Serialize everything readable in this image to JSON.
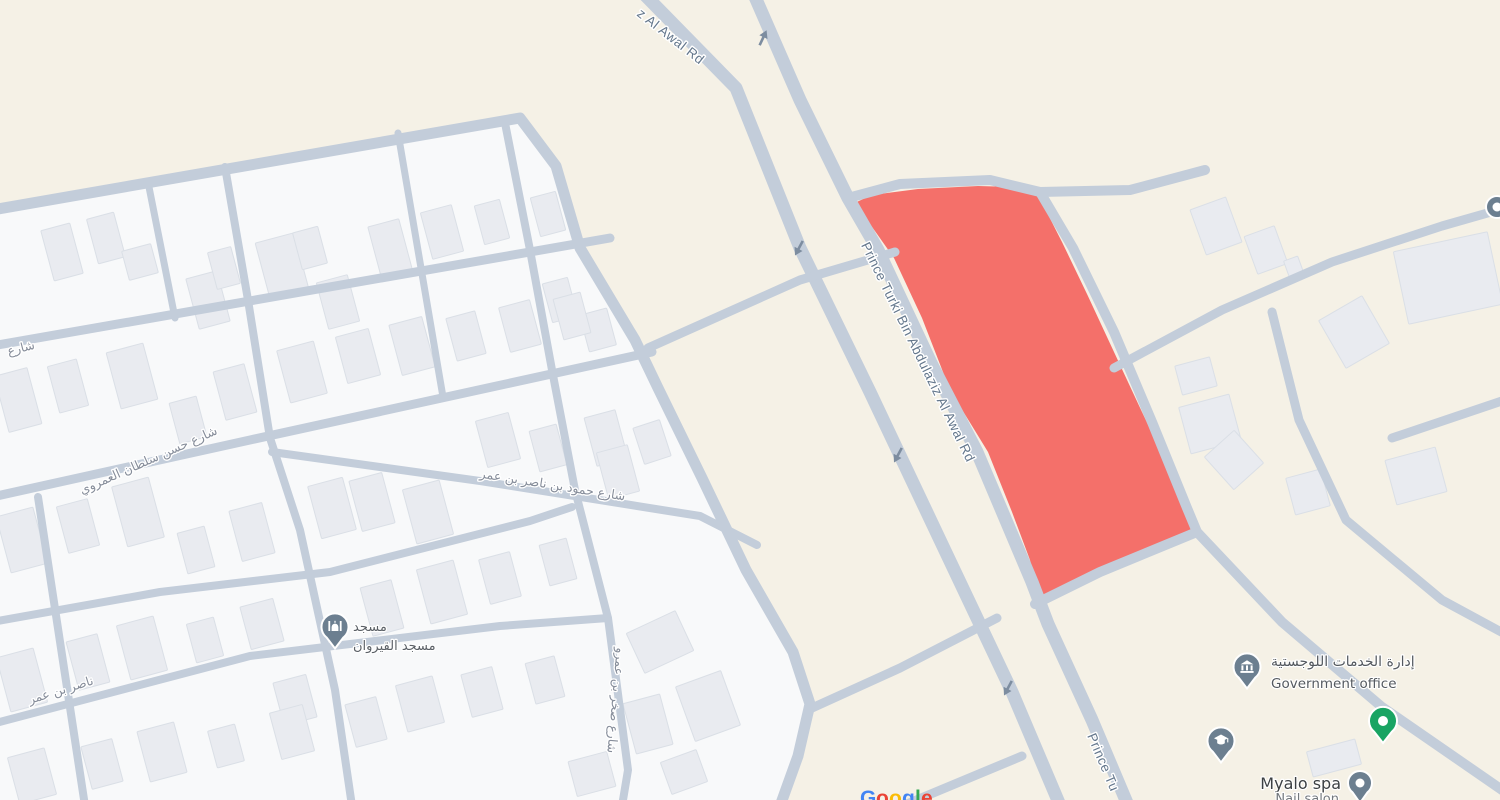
{
  "map": {
    "width": 1500,
    "height": 800,
    "colors": {
      "background": "#f5f1e6",
      "urban_fill": "#f8f9fa",
      "road": "#c3cdda",
      "building_fill": "#e9ebf0",
      "building_stroke": "#dadfe6",
      "parcel_fill": "#f4706a",
      "pin": "#6c7f90",
      "green_marker": "#19a463",
      "road_label": "#64778c",
      "street_label": "#868d9a",
      "poi_label": "#54595f",
      "arrow": "#7d8da0",
      "halo": "#ffffff"
    },
    "urban_area": "-8,212 520,120 556,168 580,250 635,342 658,390 702,480 746,572 793,654 809,705 797,756 779,806 -8,806",
    "parcel": "848,206 872,195 918,189 978,186 1014,187 1038,195 1062,242 1087,294 1114,352 1142,412 1170,472 1191,516 1197,533 1152,553 1100,576 1039,598 1030,560 1012,512 988,452 950,390 922,318 894,258 870,224",
    "roads": [
      {
        "name": "prince-turki-west-carriageway",
        "d": "M640,-10 L736,88 L800,248 L870,392 L940,540 L1012,692 L1062,810",
        "w": 13
      },
      {
        "name": "prince-turki-east-carriageway",
        "d": "M752,-10 L800,100 L848,198 L878,250 L932,365 L977,452 L1032,582 L1048,624 L1092,720 L1130,810",
        "w": 13
      },
      {
        "name": "parcel-north-road",
        "d": "M848,198 L900,184 L990,180 L1040,192 L1130,190 L1205,170",
        "w": 10
      },
      {
        "name": "parcel-east-road",
        "d": "M1040,192 L1073,248 L1114,332 L1152,422 L1187,508 L1197,532 L1282,622 L1382,707 L1505,792",
        "w": 10
      },
      {
        "name": "parcel-south-road",
        "d": "M1035,604 L1100,572 L1197,532",
        "w": 10
      },
      {
        "name": "branch-northeast-road",
        "d": "M1114,368 L1222,310 L1332,262 L1442,226 L1505,208",
        "w": 9
      },
      {
        "name": "branch-east-curve-road",
        "d": "M1272,312 L1299,420 L1346,520 L1442,600 L1505,634",
        "w": 9
      },
      {
        "name": "branch-east-stub-road",
        "d": "M1392,438 L1505,400",
        "w": 9
      },
      {
        "name": "mid-connector-road",
        "d": "M648,348 L800,280 L895,252",
        "w": 9
      },
      {
        "name": "south-connector-road",
        "d": "M812,708 L900,668 L997,618",
        "w": 9
      },
      {
        "name": "south-diagonal-road",
        "d": "M902,806 L1022,756",
        "w": 9
      },
      {
        "name": "urban-boundary-road",
        "d": "M-8,210 L520,118 L556,166 L580,248 L635,340 L658,388 L702,478 L746,570 L793,652 L810,704 L798,756 L780,806",
        "w": 11
      },
      {
        "name": "street-d2",
        "d": "M-8,346 L610,238",
        "w": 9
      },
      {
        "name": "street-hassan-sultan",
        "d": "M-8,497 L250,440 L652,352",
        "w": 9
      },
      {
        "name": "street-hamoud-nasser",
        "d": "M272,452 L480,481 L700,516 L757,545",
        "w": 8
      },
      {
        "name": "street-d4b",
        "d": "M-8,622 L160,592 L330,572 L530,521 L572,507",
        "w": 8
      },
      {
        "name": "street-d5",
        "d": "M-8,724 L250,656 L500,626 L608,618",
        "w": 8
      },
      {
        "name": "street-v0",
        "d": "M148,182 L175,318",
        "w": 7
      },
      {
        "name": "street-v1",
        "d": "M38,497 L85,806",
        "w": 8
      },
      {
        "name": "street-v2",
        "d": "M225,167 L248,300 L270,438 L300,530 L335,690 L352,806",
        "w": 8
      },
      {
        "name": "street-v2b",
        "d": "M398,133 L443,397",
        "w": 7
      },
      {
        "name": "street-sakhr",
        "d": "M505,123 L530,250 L552,370 L575,490 L608,618 L628,770 L622,806",
        "w": 8
      }
    ],
    "buildings": [
      [
        62,
        252,
        30,
        52
      ],
      [
        106,
        238,
        28,
        46
      ],
      [
        140,
        262,
        30,
        30
      ],
      [
        208,
        300,
        32,
        52
      ],
      [
        224,
        268,
        24,
        38
      ],
      [
        282,
        266,
        40,
        58
      ],
      [
        310,
        248,
        26,
        38
      ],
      [
        338,
        302,
        32,
        48
      ],
      [
        390,
        248,
        32,
        52
      ],
      [
        442,
        232,
        32,
        48
      ],
      [
        492,
        222,
        26,
        40
      ],
      [
        548,
        214,
        26,
        40
      ],
      [
        560,
        300,
        26,
        40
      ],
      [
        598,
        330,
        28,
        38
      ],
      [
        18,
        400,
        34,
        58
      ],
      [
        68,
        386,
        30,
        48
      ],
      [
        132,
        376,
        38,
        58
      ],
      [
        188,
        420,
        28,
        42
      ],
      [
        235,
        392,
        32,
        50
      ],
      [
        302,
        372,
        38,
        54
      ],
      [
        358,
        356,
        34,
        48
      ],
      [
        412,
        346,
        34,
        52
      ],
      [
        466,
        336,
        30,
        44
      ],
      [
        520,
        326,
        32,
        46
      ],
      [
        572,
        316,
        28,
        42
      ],
      [
        22,
        540,
        38,
        58
      ],
      [
        78,
        526,
        32,
        48
      ],
      [
        138,
        512,
        38,
        62
      ],
      [
        196,
        550,
        28,
        42
      ],
      [
        252,
        532,
        34,
        52
      ],
      [
        332,
        508,
        36,
        54
      ],
      [
        372,
        502,
        34,
        52
      ],
      [
        428,
        512,
        38,
        56
      ],
      [
        498,
        440,
        34,
        48
      ],
      [
        548,
        448,
        28,
        42
      ],
      [
        606,
        438,
        32,
        50
      ],
      [
        22,
        680,
        38,
        56
      ],
      [
        88,
        662,
        32,
        50
      ],
      [
        142,
        648,
        38,
        56
      ],
      [
        205,
        640,
        28,
        40
      ],
      [
        262,
        624,
        34,
        44
      ],
      [
        295,
        700,
        34,
        44
      ],
      [
        382,
        608,
        32,
        50
      ],
      [
        442,
        592,
        38,
        56
      ],
      [
        500,
        578,
        32,
        46
      ],
      [
        558,
        562,
        28,
        42
      ],
      [
        32,
        776,
        38,
        48
      ],
      [
        102,
        764,
        32,
        44
      ],
      [
        162,
        752,
        38,
        52
      ],
      [
        226,
        746,
        28,
        38
      ],
      [
        292,
        732,
        34,
        48
      ],
      [
        366,
        722,
        32,
        44
      ],
      [
        420,
        704,
        38,
        48
      ],
      [
        482,
        692,
        32,
        44
      ],
      [
        545,
        680,
        30,
        42
      ],
      [
        660,
        642,
        54,
        44,
        -25
      ],
      [
        708,
        706,
        48,
        58,
        -20
      ],
      [
        648,
        724,
        38,
        52
      ],
      [
        592,
        774,
        40,
        36
      ],
      [
        684,
        772,
        38,
        34,
        -20
      ],
      [
        618,
        472,
        32,
        48
      ],
      [
        652,
        442,
        28,
        38,
        -18
      ],
      [
        1216,
        226,
        38,
        48,
        -20
      ],
      [
        1266,
        250,
        32,
        40,
        -20
      ],
      [
        1294,
        268,
        15,
        20,
        -20
      ],
      [
        1448,
        278,
        96,
        74,
        -12
      ],
      [
        1354,
        332,
        50,
        55,
        -30
      ],
      [
        1196,
        376,
        36,
        30
      ],
      [
        1210,
        424,
        52,
        48
      ],
      [
        1234,
        460,
        40,
        44,
        -42
      ],
      [
        1416,
        476,
        52,
        46
      ],
      [
        1308,
        492,
        36,
        38
      ],
      [
        1334,
        758,
        50,
        26
      ]
    ],
    "arrows": [
      {
        "x": 763,
        "y": 38,
        "rot": 205
      },
      {
        "x": 799,
        "y": 248,
        "rot": 28
      },
      {
        "x": 898,
        "y": 455,
        "rot": 28
      },
      {
        "x": 1008,
        "y": 688,
        "rot": 28
      }
    ],
    "road_labels": [
      {
        "text": "z Al Awal Rd",
        "x": 668,
        "y": 40,
        "rot": 38,
        "size": 13.5
      },
      {
        "text": "Prince Turki Bin Abdulaziz Al Awal Rd",
        "x": 914,
        "y": 354,
        "rot": 64,
        "size": 13.5
      },
      {
        "text": "Prince Tu",
        "x": 1099,
        "y": 764,
        "rot": 67,
        "size": 13.5
      }
    ],
    "street_labels": [
      {
        "text": "شارع",
        "x": 22,
        "y": 352,
        "rot": -14,
        "size": 12.5
      },
      {
        "text": "شارع حسن سلطان العمروي",
        "x": 150,
        "y": 464,
        "rot": -24,
        "size": 12.5
      },
      {
        "text": "شارع حمود بن ناصر بن عمر",
        "x": 552,
        "y": 489,
        "rot": 9,
        "size": 12.5
      },
      {
        "text": "ناصر بن عمر",
        "x": 62,
        "y": 694,
        "rot": -17,
        "size": 12.5
      },
      {
        "text": "شارع صخر بن عمرو",
        "x": 612,
        "y": 700,
        "rot": 95,
        "size": 12.5
      }
    ],
    "pois": [
      {
        "type": "mosque",
        "x": 335,
        "y": 627,
        "labels": [
          {
            "text": "مسجد",
            "x": 353,
            "y": 631,
            "size": 13,
            "anchor": "start",
            "color": "#5b6066"
          },
          {
            "text": "مسجد القيروان",
            "x": 353,
            "y": 650,
            "size": 13,
            "anchor": "start",
            "color": "#5b6066"
          }
        ]
      },
      {
        "type": "government",
        "x": 1247,
        "y": 667,
        "labels": [
          {
            "text": "إدارة الخدمات اللوجستية",
            "x": 1271,
            "y": 666,
            "size": 14,
            "anchor": "start",
            "color": "#54595f"
          },
          {
            "text": "Government office",
            "x": 1271,
            "y": 688,
            "size": 13.5,
            "anchor": "start",
            "color": "#54595f"
          }
        ]
      },
      {
        "type": "education",
        "x": 1221,
        "y": 741,
        "labels": []
      },
      {
        "type": "green",
        "x": 1383,
        "y": 721,
        "labels": []
      },
      {
        "type": "spa",
        "x": 1360,
        "y": 783,
        "labels": [
          {
            "text": "Myalo spa",
            "x": 1341,
            "y": 789,
            "size": 16,
            "anchor": "end",
            "color": "#3c4043"
          },
          {
            "text": "Nail salon",
            "x": 1339,
            "y": 803,
            "size": 13,
            "anchor": "end",
            "color": "#73787d"
          }
        ]
      },
      {
        "type": "edge-dot",
        "x": 1497,
        "y": 207,
        "labels": []
      }
    ],
    "attribution": {
      "y": 805,
      "size": 21,
      "letters": [
        {
          "ch": "G",
          "x": 860,
          "color": "#4285F4"
        },
        {
          "ch": "o",
          "x": 876,
          "color": "#EA4335"
        },
        {
          "ch": "o",
          "x": 889,
          "color": "#FBBC05"
        },
        {
          "ch": "g",
          "x": 902,
          "color": "#4285F4"
        },
        {
          "ch": "l",
          "x": 915,
          "color": "#34A853"
        },
        {
          "ch": "e",
          "x": 921,
          "color": "#EA4335"
        }
      ]
    }
  }
}
